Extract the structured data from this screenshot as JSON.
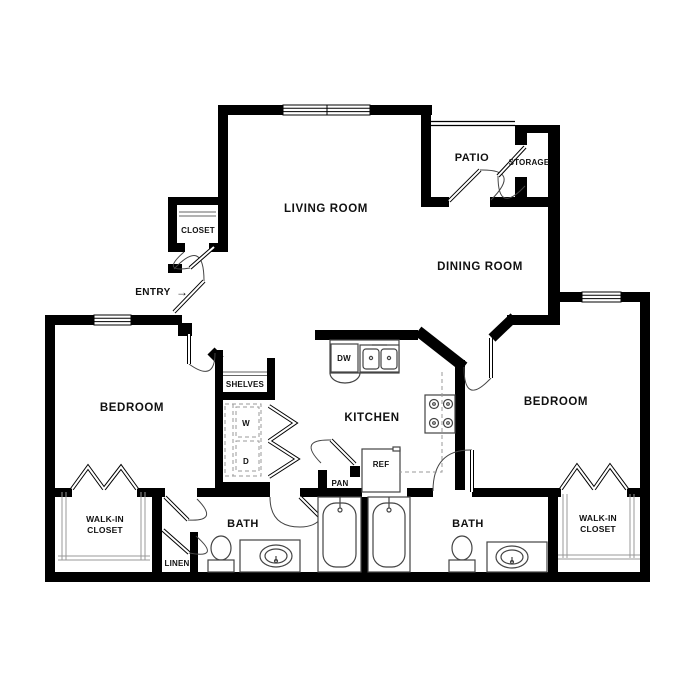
{
  "colors": {
    "wall": "#000000",
    "background": "#ffffff",
    "fixture_line": "#444444",
    "rod_line": "#999999"
  },
  "rooms": {
    "living_room": {
      "label": "LIVING ROOM"
    },
    "dining_room": {
      "label": "DINING ROOM"
    },
    "kitchen": {
      "label": "KITCHEN"
    },
    "bedroom_left": {
      "label": "BEDROOM"
    },
    "bedroom_right": {
      "label": "BEDROOM"
    },
    "bath_left": {
      "label": "BATH"
    },
    "bath_right": {
      "label": "BATH"
    },
    "patio": {
      "label": "PATIO"
    },
    "storage": {
      "label": "STORAGE"
    },
    "entry_closet": {
      "label": "CLOSET"
    },
    "shelves": {
      "label": "SHELVES"
    },
    "pantry": {
      "label": "PAN"
    },
    "linen": {
      "label": "LINEN"
    },
    "walk_in_closet_left": {
      "line1": "WALK-IN",
      "line2": "CLOSET"
    },
    "walk_in_closet_right": {
      "line1": "WALK-IN",
      "line2": "CLOSET"
    }
  },
  "fixtures": {
    "washer": "W",
    "dryer": "D",
    "dishwasher": "DW",
    "refrigerator": "REF"
  },
  "entry": {
    "label": "ENTRY",
    "arrow": "→"
  }
}
